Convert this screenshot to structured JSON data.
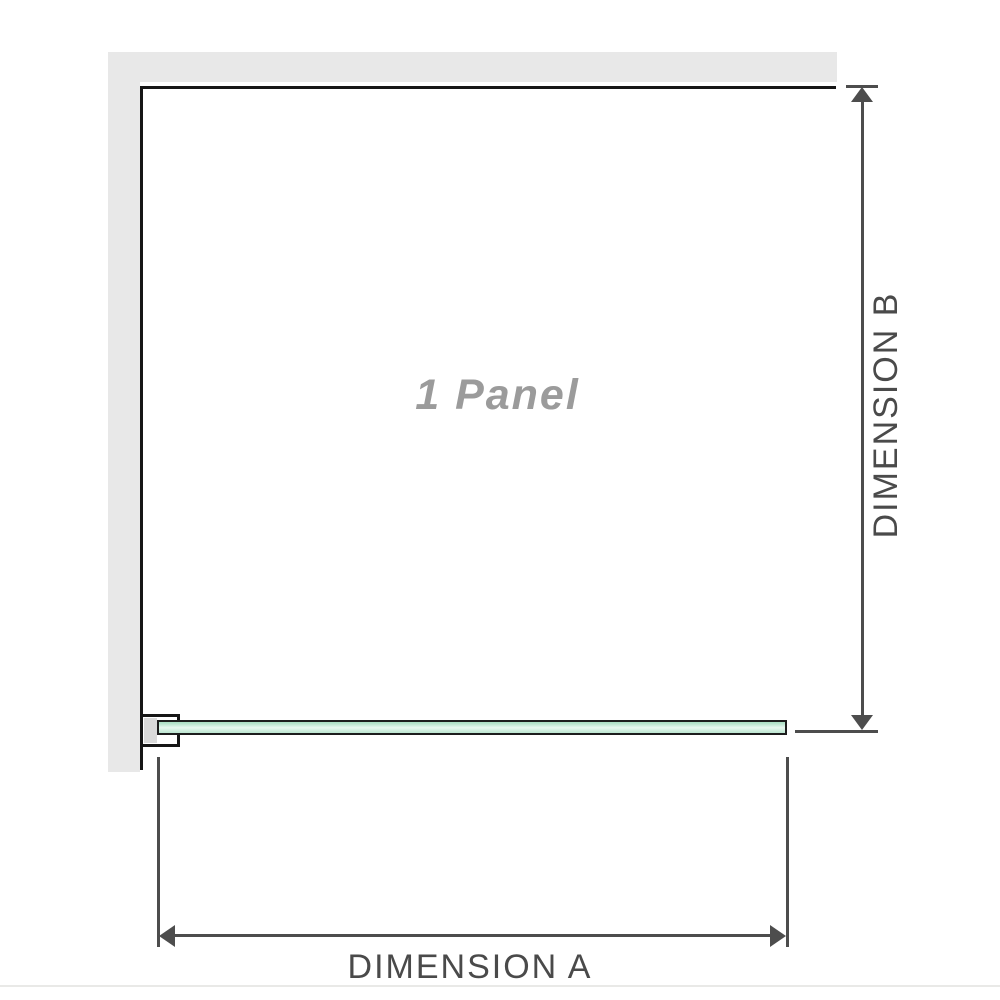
{
  "diagram": {
    "panel_label": "1 Panel",
    "dimension_a": {
      "label": "DIMENSION A"
    },
    "dimension_b": {
      "label": "DIMENSION B"
    }
  },
  "icons": {
    "arrow_up": "arrowhead-up-icon",
    "arrow_down": "arrowhead-down-icon",
    "arrow_left": "arrowhead-left-icon",
    "arrow_right": "arrowhead-right-icon"
  },
  "colors": {
    "background": "#ffffff",
    "wall": "#e8e8e8",
    "outline": "#161616",
    "dimension": "#4d4d4d",
    "label": "#4a4a4a",
    "watermark": "#9b9b9b",
    "bracket_insert": "#dadada",
    "glass_border": "#1d1d1d",
    "glass_green": "#aee0c6",
    "glass_highlight": "#e9f8f0",
    "glass_green_2": "#bfe7d2",
    "divider": "#e9e9e7"
  }
}
